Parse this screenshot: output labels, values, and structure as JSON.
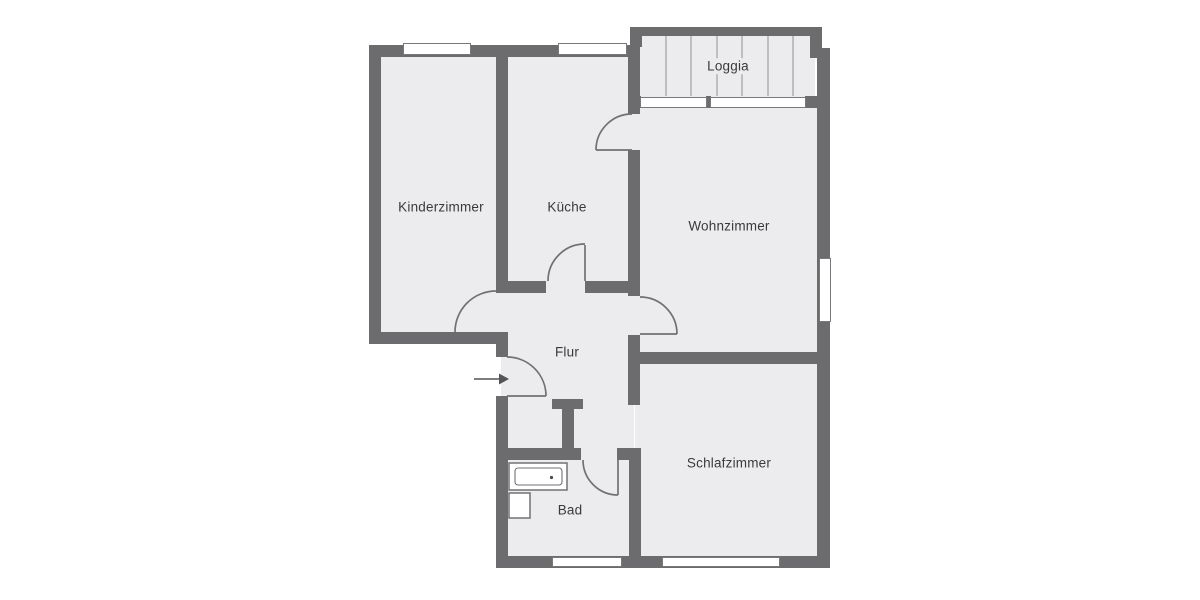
{
  "plan": {
    "type": "apartment-floor-plan",
    "rooms": [
      {
        "id": "kinderzimmer",
        "label": "Kinderzimmer"
      },
      {
        "id": "kueche",
        "label": "Küche"
      },
      {
        "id": "loggia",
        "label": "Loggia"
      },
      {
        "id": "wohnzimmer",
        "label": "Wohnzimmer"
      },
      {
        "id": "flur",
        "label": "Flur"
      },
      {
        "id": "bad",
        "label": "Bad"
      },
      {
        "id": "schlafzimmer",
        "label": "Schlafzimmer"
      }
    ],
    "fixtures": [
      {
        "id": "bathtub",
        "room": "bad",
        "shape": "rect-with-inner-rect-and-drain-dot"
      },
      {
        "id": "washbasin",
        "room": "bad",
        "shape": "small-square"
      },
      {
        "id": "entrance-arrow",
        "room": "flur",
        "shape": "right-arrow"
      }
    ],
    "door_count": 6,
    "window_count": 7
  },
  "colors": {
    "background": "#ffffff",
    "room_fill": "#ececee",
    "wall": "#6c6c6e",
    "line": "#707174",
    "window_border": "#77787a",
    "window_fill": "#ffffff",
    "hatch": "#a6a6a9",
    "text": "#3a3a3c",
    "arrow": "#535456"
  }
}
